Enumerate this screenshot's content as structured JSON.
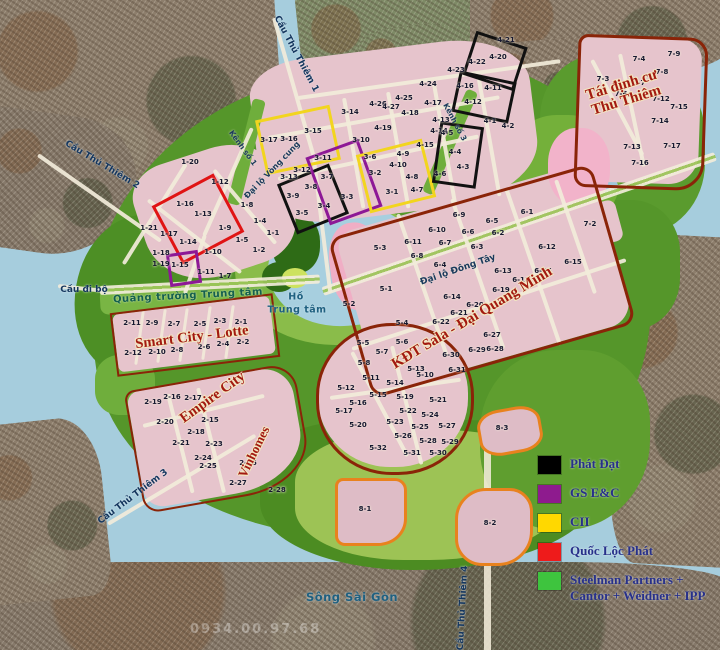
{
  "legend": {
    "items": [
      {
        "color": "#000000",
        "label": "Phát Đạt"
      },
      {
        "color": "#8e1b8e",
        "label": "GS E&C"
      },
      {
        "color": "#ffd800",
        "label": "CII"
      },
      {
        "color": "#ee1b1b",
        "label": "Quốc Lộc Phát"
      },
      {
        "color": "#3ec43e",
        "label": "Steelman Partners + Cantor + Weidner + IPP"
      }
    ]
  },
  "watermark": "0934.00.97.68",
  "labels": {
    "regions": [
      {
        "text": "Smart City - Lotte",
        "x": 192,
        "y": 338,
        "r": -7,
        "s": 14.5
      },
      {
        "text": "Empire City",
        "x": 213,
        "y": 398,
        "r": -36,
        "s": 14.5
      },
      {
        "text": "Vinhomes",
        "x": 254,
        "y": 452,
        "r": -64,
        "s": 13
      },
      {
        "text": "KĐT Sala - Đại Quang Minh",
        "x": 472,
        "y": 318,
        "r": -31,
        "s": 15
      },
      {
        "text": "Tái định cư\nThủ Thiêm",
        "x": 624,
        "y": 93,
        "r": -17,
        "s": 15
      }
    ],
    "streets": [
      {
        "text": "Đại lộ Vòng cung",
        "x": 272,
        "y": 170,
        "r": -46,
        "s": 8
      },
      {
        "text": "Đại lộ Đông Tây",
        "x": 458,
        "y": 270,
        "r": -19,
        "s": 9
      },
      {
        "text": "Kênh số 1",
        "x": 243,
        "y": 148,
        "r": 54,
        "s": 7.5
      },
      {
        "text": "Kênh số 3",
        "x": 455,
        "y": 122,
        "r": 62,
        "s": 7.5
      },
      {
        "text": "Quảng trường Trung tâm",
        "x": 188,
        "y": 296,
        "r": -3,
        "s": 10,
        "cls": "plaza"
      }
    ],
    "bridges": [
      {
        "text": "Cầu Thủ Thiêm 1",
        "x": 296,
        "y": 54,
        "r": 62
      },
      {
        "text": "Cầu Thủ Thiêm 2",
        "x": 102,
        "y": 165,
        "r": 31
      },
      {
        "text": "Cầu Thủ Thiêm 3",
        "x": 133,
        "y": 497,
        "r": -37
      },
      {
        "text": "Cầu Thủ Thiêm 4",
        "x": 463,
        "y": 608,
        "r": -87
      },
      {
        "text": "Cầu đi bộ",
        "x": 84,
        "y": 290,
        "r": 0
      }
    ],
    "waters": [
      {
        "text": "Sông Sài Gòn",
        "x": 352,
        "y": 597
      },
      {
        "text": "Hồ",
        "x": 296,
        "y": 297,
        "s": 9.5
      },
      {
        "text": "Trung tâm",
        "x": 297,
        "y": 310,
        "s": 9.5
      }
    ],
    "lots": [
      {
        "t": "1-20",
        "x": 190,
        "y": 162
      },
      {
        "t": "1-12",
        "x": 220,
        "y": 182
      },
      {
        "t": "1-16",
        "x": 185,
        "y": 204
      },
      {
        "t": "1-13",
        "x": 203,
        "y": 214
      },
      {
        "t": "1-8",
        "x": 247,
        "y": 205
      },
      {
        "t": "1-4",
        "x": 260,
        "y": 221
      },
      {
        "t": "1-9",
        "x": 225,
        "y": 228
      },
      {
        "t": "1-21",
        "x": 149,
        "y": 228
      },
      {
        "t": "1-17",
        "x": 169,
        "y": 234
      },
      {
        "t": "1-14",
        "x": 188,
        "y": 242
      },
      {
        "t": "1-5",
        "x": 242,
        "y": 240
      },
      {
        "t": "1-1",
        "x": 273,
        "y": 233
      },
      {
        "t": "1-2",
        "x": 259,
        "y": 250
      },
      {
        "t": "1-10",
        "x": 213,
        "y": 252
      },
      {
        "t": "1-18",
        "x": 161,
        "y": 253
      },
      {
        "t": "1-19",
        "x": 161,
        "y": 264
      },
      {
        "t": "1-15",
        "x": 180,
        "y": 265
      },
      {
        "t": "1-11",
        "x": 206,
        "y": 272
      },
      {
        "t": "1-7",
        "x": 225,
        "y": 276
      },
      {
        "t": "2-11",
        "x": 132,
        "y": 323
      },
      {
        "t": "2-9",
        "x": 152,
        "y": 323
      },
      {
        "t": "2-7",
        "x": 174,
        "y": 324
      },
      {
        "t": "2-5",
        "x": 200,
        "y": 324
      },
      {
        "t": "2-3",
        "x": 220,
        "y": 321
      },
      {
        "t": "2-1",
        "x": 241,
        "y": 322
      },
      {
        "t": "2-12",
        "x": 133,
        "y": 353
      },
      {
        "t": "2-10",
        "x": 157,
        "y": 352
      },
      {
        "t": "2-8",
        "x": 177,
        "y": 350
      },
      {
        "t": "2-6",
        "x": 204,
        "y": 347
      },
      {
        "t": "2-4",
        "x": 223,
        "y": 344
      },
      {
        "t": "2-2",
        "x": 243,
        "y": 342
      },
      {
        "t": "2-19",
        "x": 153,
        "y": 402
      },
      {
        "t": "2-16",
        "x": 172,
        "y": 397
      },
      {
        "t": "2-17",
        "x": 193,
        "y": 398
      },
      {
        "t": "2-20",
        "x": 165,
        "y": 422
      },
      {
        "t": "2-15",
        "x": 210,
        "y": 420
      },
      {
        "t": "2-18",
        "x": 196,
        "y": 432
      },
      {
        "t": "2-21",
        "x": 181,
        "y": 443
      },
      {
        "t": "2-23",
        "x": 214,
        "y": 444
      },
      {
        "t": "2-24",
        "x": 203,
        "y": 458
      },
      {
        "t": "2-25",
        "x": 208,
        "y": 466
      },
      {
        "t": "2-26",
        "x": 248,
        "y": 463
      },
      {
        "t": "2-27",
        "x": 238,
        "y": 483
      },
      {
        "t": "2-28",
        "x": 277,
        "y": 490
      },
      {
        "t": "3-17",
        "x": 269,
        "y": 140
      },
      {
        "t": "3-16",
        "x": 289,
        "y": 139
      },
      {
        "t": "3-15",
        "x": 313,
        "y": 131
      },
      {
        "t": "3-14",
        "x": 350,
        "y": 112
      },
      {
        "t": "3-10",
        "x": 361,
        "y": 140
      },
      {
        "t": "3-11",
        "x": 323,
        "y": 158
      },
      {
        "t": "3-12",
        "x": 302,
        "y": 170
      },
      {
        "t": "3-13",
        "x": 289,
        "y": 177
      },
      {
        "t": "3-7",
        "x": 327,
        "y": 177
      },
      {
        "t": "3-8",
        "x": 311,
        "y": 187
      },
      {
        "t": "3-9",
        "x": 293,
        "y": 196
      },
      {
        "t": "3-5",
        "x": 302,
        "y": 213
      },
      {
        "t": "3-4",
        "x": 324,
        "y": 206
      },
      {
        "t": "3-3",
        "x": 347,
        "y": 197
      },
      {
        "t": "3-6",
        "x": 370,
        "y": 157
      },
      {
        "t": "3-2",
        "x": 375,
        "y": 173
      },
      {
        "t": "3-1",
        "x": 392,
        "y": 192
      },
      {
        "t": "4-26",
        "x": 378,
        "y": 104
      },
      {
        "t": "4-27",
        "x": 391,
        "y": 107
      },
      {
        "t": "4-25",
        "x": 404,
        "y": 98
      },
      {
        "t": "4-24",
        "x": 428,
        "y": 84
      },
      {
        "t": "4-23",
        "x": 456,
        "y": 70
      },
      {
        "t": "4-22",
        "x": 477,
        "y": 62
      },
      {
        "t": "4-20",
        "x": 498,
        "y": 57
      },
      {
        "t": "4-21",
        "x": 506,
        "y": 40
      },
      {
        "t": "4-18",
        "x": 410,
        "y": 113
      },
      {
        "t": "4-17",
        "x": 433,
        "y": 103
      },
      {
        "t": "4-16",
        "x": 465,
        "y": 86
      },
      {
        "t": "4-11",
        "x": 493,
        "y": 88
      },
      {
        "t": "4-12",
        "x": 473,
        "y": 102
      },
      {
        "t": "4-19",
        "x": 383,
        "y": 128
      },
      {
        "t": "4-13",
        "x": 441,
        "y": 120
      },
      {
        "t": "4-14",
        "x": 439,
        "y": 131
      },
      {
        "t": "4-15",
        "x": 425,
        "y": 145
      },
      {
        "t": "4-9",
        "x": 403,
        "y": 154
      },
      {
        "t": "4-10",
        "x": 398,
        "y": 165
      },
      {
        "t": "4-8",
        "x": 412,
        "y": 177
      },
      {
        "t": "4-7",
        "x": 417,
        "y": 190
      },
      {
        "t": "4-5",
        "x": 447,
        "y": 133
      },
      {
        "t": "4-4",
        "x": 455,
        "y": 152
      },
      {
        "t": "4-3",
        "x": 463,
        "y": 167
      },
      {
        "t": "4-6",
        "x": 440,
        "y": 174
      },
      {
        "t": "4-1",
        "x": 490,
        "y": 121
      },
      {
        "t": "4-2",
        "x": 508,
        "y": 126
      },
      {
        "t": "5-3",
        "x": 380,
        "y": 248
      },
      {
        "t": "5-1",
        "x": 386,
        "y": 289
      },
      {
        "t": "5-2",
        "x": 349,
        "y": 304
      },
      {
        "t": "5-4",
        "x": 402,
        "y": 323
      },
      {
        "t": "5-5",
        "x": 363,
        "y": 343
      },
      {
        "t": "5-6",
        "x": 402,
        "y": 342
      },
      {
        "t": "5-7",
        "x": 382,
        "y": 352
      },
      {
        "t": "5-8",
        "x": 364,
        "y": 363
      },
      {
        "t": "5-13",
        "x": 416,
        "y": 369
      },
      {
        "t": "5-10",
        "x": 425,
        "y": 375
      },
      {
        "t": "5-11",
        "x": 371,
        "y": 378
      },
      {
        "t": "5-14",
        "x": 395,
        "y": 383
      },
      {
        "t": "5-12",
        "x": 346,
        "y": 388
      },
      {
        "t": "5-15",
        "x": 378,
        "y": 395
      },
      {
        "t": "5-19",
        "x": 405,
        "y": 397
      },
      {
        "t": "5-21",
        "x": 438,
        "y": 400
      },
      {
        "t": "5-16",
        "x": 358,
        "y": 403
      },
      {
        "t": "5-17",
        "x": 344,
        "y": 411
      },
      {
        "t": "5-22",
        "x": 408,
        "y": 411
      },
      {
        "t": "5-24",
        "x": 430,
        "y": 415
      },
      {
        "t": "5-23",
        "x": 395,
        "y": 422
      },
      {
        "t": "5-20",
        "x": 358,
        "y": 425
      },
      {
        "t": "5-25",
        "x": 420,
        "y": 427
      },
      {
        "t": "5-27",
        "x": 447,
        "y": 426
      },
      {
        "t": "5-26",
        "x": 403,
        "y": 436
      },
      {
        "t": "5-28",
        "x": 428,
        "y": 441
      },
      {
        "t": "5-29",
        "x": 450,
        "y": 442
      },
      {
        "t": "5-30",
        "x": 438,
        "y": 453
      },
      {
        "t": "5-31",
        "x": 412,
        "y": 453
      },
      {
        "t": "5-32",
        "x": 378,
        "y": 448
      },
      {
        "t": "6-1",
        "x": 527,
        "y": 212
      },
      {
        "t": "6-9",
        "x": 459,
        "y": 215
      },
      {
        "t": "6-5",
        "x": 492,
        "y": 221
      },
      {
        "t": "6-10",
        "x": 437,
        "y": 230
      },
      {
        "t": "6-6",
        "x": 468,
        "y": 232
      },
      {
        "t": "6-2",
        "x": 498,
        "y": 233
      },
      {
        "t": "6-11",
        "x": 413,
        "y": 242
      },
      {
        "t": "6-7",
        "x": 445,
        "y": 243
      },
      {
        "t": "6-3",
        "x": 477,
        "y": 247
      },
      {
        "t": "6-12",
        "x": 547,
        "y": 247
      },
      {
        "t": "6-8",
        "x": 417,
        "y": 256
      },
      {
        "t": "6-4",
        "x": 440,
        "y": 265
      },
      {
        "t": "6-15",
        "x": 573,
        "y": 262
      },
      {
        "t": "6-13",
        "x": 503,
        "y": 271
      },
      {
        "t": "6-16",
        "x": 543,
        "y": 271
      },
      {
        "t": "6-18",
        "x": 521,
        "y": 280
      },
      {
        "t": "6-19",
        "x": 501,
        "y": 290
      },
      {
        "t": "6-14",
        "x": 452,
        "y": 297
      },
      {
        "t": "6-20",
        "x": 475,
        "y": 305
      },
      {
        "t": "6-21",
        "x": 459,
        "y": 313
      },
      {
        "t": "6-22",
        "x": 441,
        "y": 322
      },
      {
        "t": "6-27",
        "x": 492,
        "y": 335
      },
      {
        "t": "6-29",
        "x": 477,
        "y": 350
      },
      {
        "t": "6-28",
        "x": 495,
        "y": 349
      },
      {
        "t": "6-30",
        "x": 451,
        "y": 355
      },
      {
        "t": "6-31",
        "x": 457,
        "y": 370
      },
      {
        "t": "7-9",
        "x": 674,
        "y": 54
      },
      {
        "t": "7-4",
        "x": 639,
        "y": 59
      },
      {
        "t": "7-8",
        "x": 662,
        "y": 72
      },
      {
        "t": "7-3",
        "x": 603,
        "y": 79
      },
      {
        "t": "7-7",
        "x": 639,
        "y": 83
      },
      {
        "t": "7-6",
        "x": 621,
        "y": 94
      },
      {
        "t": "7-12",
        "x": 661,
        "y": 99
      },
      {
        "t": "7-15",
        "x": 679,
        "y": 107
      },
      {
        "t": "7-14",
        "x": 660,
        "y": 121
      },
      {
        "t": "7-13",
        "x": 632,
        "y": 147
      },
      {
        "t": "7-17",
        "x": 672,
        "y": 146
      },
      {
        "t": "7-16",
        "x": 640,
        "y": 163
      },
      {
        "t": "7-2",
        "x": 590,
        "y": 224
      },
      {
        "t": "8-3",
        "x": 502,
        "y": 428
      },
      {
        "t": "8-1",
        "x": 365,
        "y": 509
      },
      {
        "t": "8-2",
        "x": 490,
        "y": 523
      }
    ]
  }
}
